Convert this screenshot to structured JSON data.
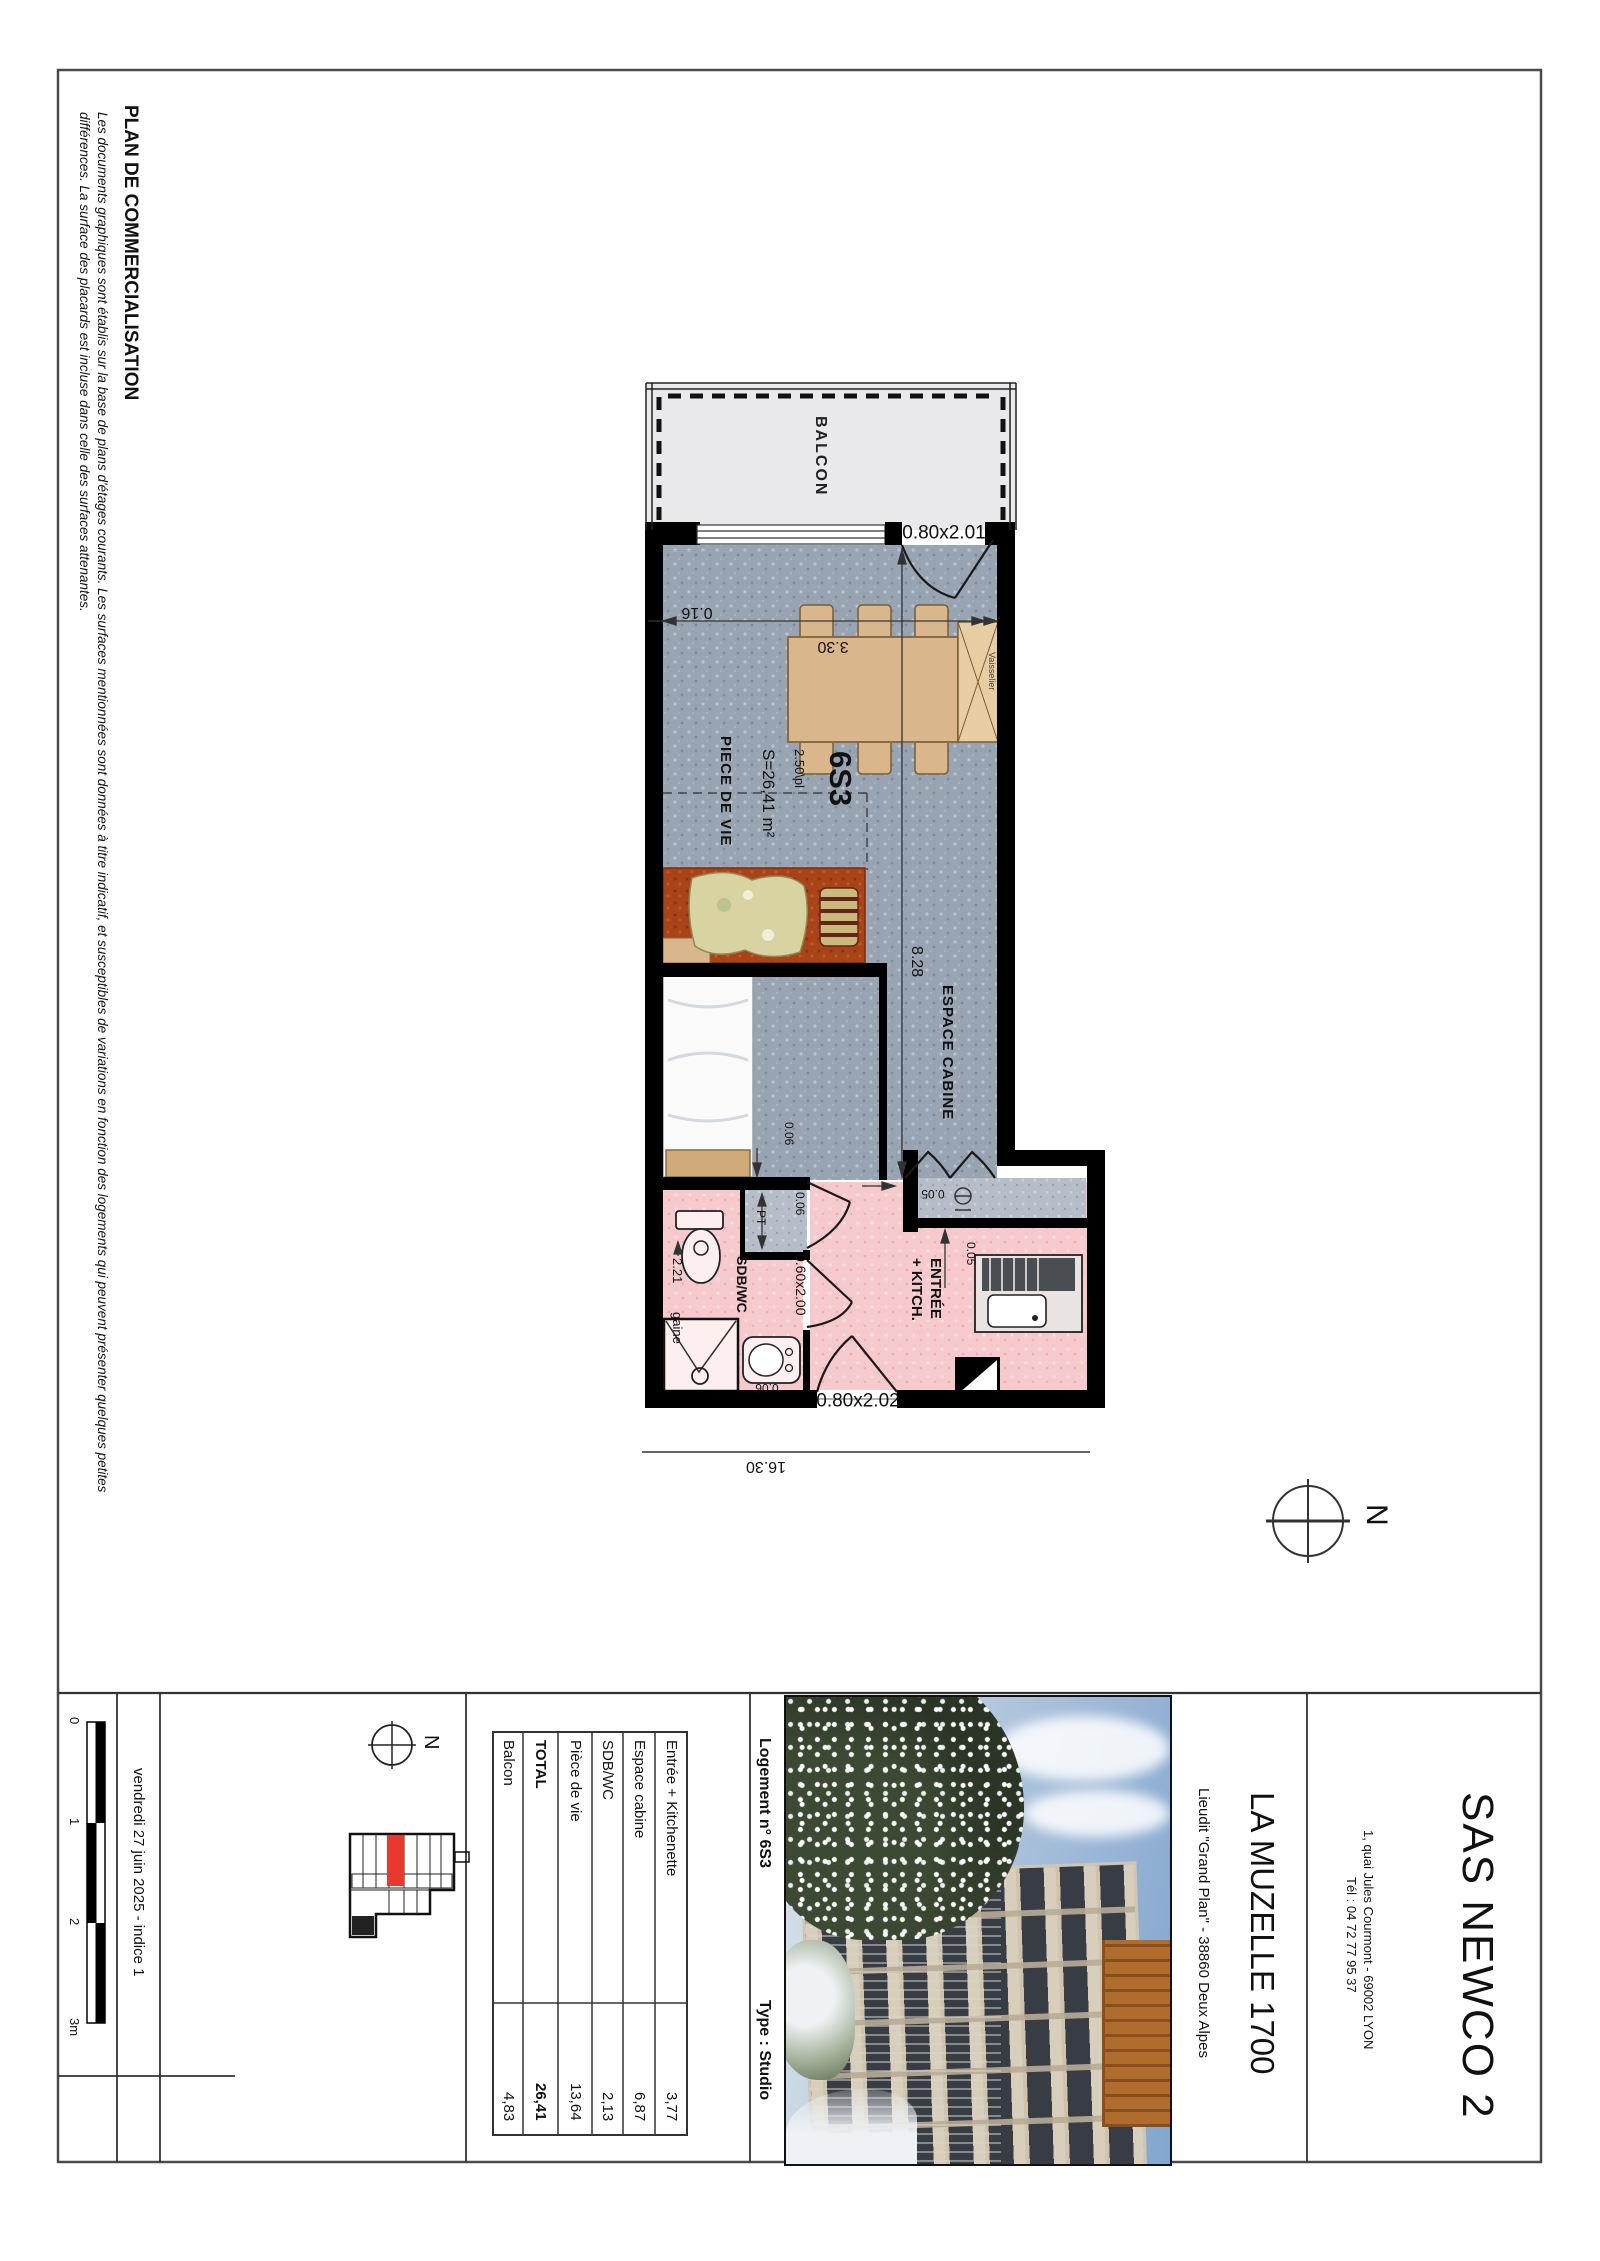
{
  "page": {
    "title": "PLAN DE COMMERCIALISATION",
    "disclaimer1": "Les documents graphiques sont établis sur la base de plans d'étages courants. Les surfaces mentionnées sont données à titre indicatif, et susceptibles de variations en fonction des logements qui peuvent présenter quelques petites",
    "disclaimer2": "différences. La surface des placards est incluse dans celle des surfaces attenantes."
  },
  "plan": {
    "unit": "6S3",
    "surface": "S=26,41 m²",
    "ceiling": "2.50\\pl",
    "rooms": {
      "balcony": "BALCON",
      "living": "PIECE DE VIE",
      "cabin": "ESPACE CABINE",
      "bathroom": "SDB/WC",
      "entry_line1": "ENTRÉE",
      "entry_line2": "+ KITCH.",
      "dresser": "Vaisselier"
    },
    "dims": {
      "balcony_door": "0.80x2.01",
      "entry_door": "0.80x2.02",
      "bath_door": "0.60x2.00",
      "width": "3.30",
      "wall": "0.16",
      "length": "8.28",
      "total": "16.30",
      "gap_bed": "0.06",
      "gap_niche": "0.06",
      "gap_shower": "0.06",
      "duct": "PT",
      "kitchen_top": "0.05",
      "kitchen_side": "0.05",
      "bath_width": "2.21",
      "duct_label": "gaine"
    }
  },
  "compass": {
    "label": "N"
  },
  "titleblock": {
    "scale": {
      "labels": [
        "0",
        "1",
        "2",
        "3m"
      ]
    },
    "date": "vendredi 27 juin 2025 - indice 1",
    "unit_header": "Logement n° 6S3",
    "type_header": "Type : Studio",
    "areas": [
      {
        "label": "Balcon",
        "value": "4,83"
      },
      {
        "label": "TOTAL",
        "value": "26,41"
      },
      {
        "label": "Pièce de vie",
        "value": "13,64"
      },
      {
        "label": "SDB/WC",
        "value": "2,13"
      },
      {
        "label": "Espace cabine",
        "value": "6,87"
      },
      {
        "label": "Entrée + Kitchenette",
        "value": "3,77"
      }
    ],
    "residence": {
      "name": "LA MUZELLE 1700",
      "location": "Lieudit \"Grand Plan\" - 38860 Deux Alpes"
    },
    "company": {
      "name": "SAS NEWCO 2",
      "address": "1, quai Jules Courmont - 69002 LYON",
      "phone": "Tél : 04 72 77 95 37"
    }
  },
  "colors": {
    "highlight": "#e8392e",
    "floor": "#99a4b3",
    "wet_rooms": "#f6c9cd",
    "balcony": "#e9e9ec",
    "wood": "#d9b68c",
    "sofa": "#a84418",
    "walls": "#000000"
  }
}
